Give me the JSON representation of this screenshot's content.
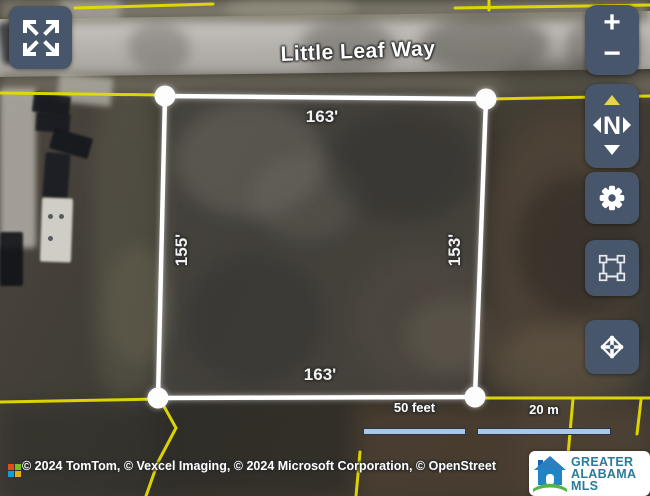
{
  "street": {
    "label": "Little Leaf Way"
  },
  "parcel": {
    "top_dimension": "163'",
    "left_dimension": "155'",
    "right_dimension": "153'",
    "bottom_dimension": "163'"
  },
  "controls": {
    "zoom_in_label": "+",
    "zoom_out_label": "−",
    "compass_label": "N"
  },
  "scalebar": {
    "feet_label": "50 feet",
    "meters_label": "20 m"
  },
  "attribution": {
    "text": "© 2024 TomTom, © Vexcel Imaging, © 2024 Microsoft Corporation, © OpenStreet"
  },
  "logo": {
    "line1": "GREATER",
    "line2": "ALABAMA",
    "line3": "MLS"
  },
  "colors": {
    "control_background": "#47566a",
    "parcel_boundary_yellow": "#e4dc00",
    "parcel_outline_white": "#ffffff",
    "north_arrow_yellow": "#e8d44d",
    "scalebar_fill": "#a9c8e8",
    "logo_text_teal": "#2b7c99",
    "logo_house_blue": "#2a7fc1",
    "logo_house_green": "#54b544"
  }
}
